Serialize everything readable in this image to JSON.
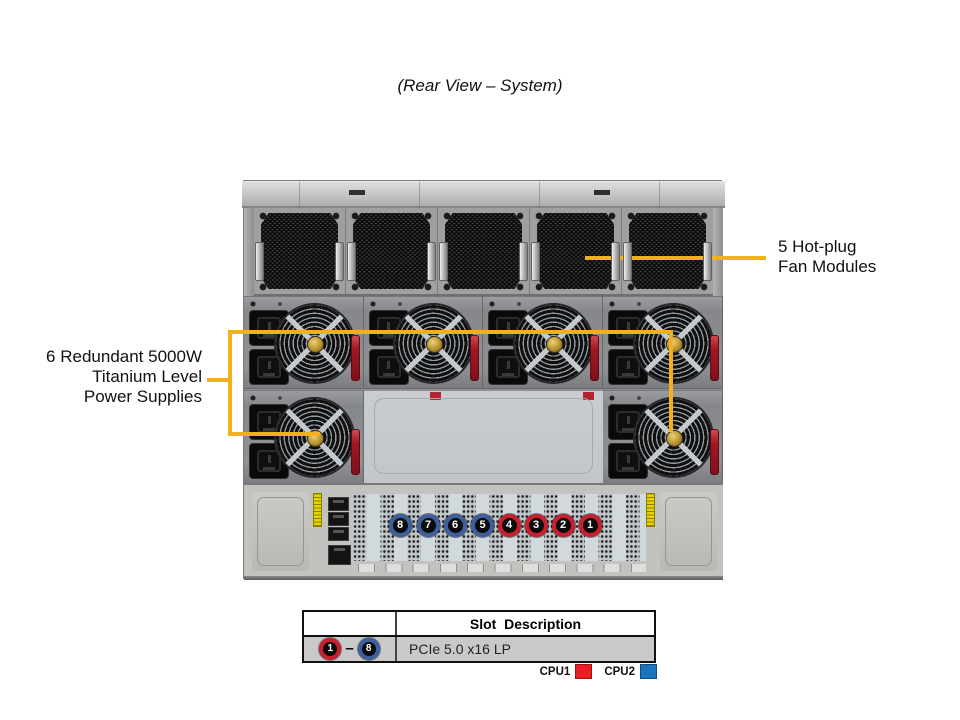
{
  "title": "(Rear View – System)",
  "callouts": {
    "fans": {
      "line1": "5 Hot-plug",
      "line2": "Fan Modules"
    },
    "psu": {
      "line1": "6 Redundant 5000W",
      "line2": "Titanium Level",
      "line3": "Power Supplies"
    }
  },
  "rear_slots": {
    "items": [
      {
        "number": "8",
        "cpu": "2"
      },
      {
        "number": "7",
        "cpu": "2"
      },
      {
        "number": "6",
        "cpu": "2"
      },
      {
        "number": "5",
        "cpu": "2"
      },
      {
        "number": "4",
        "cpu": "1"
      },
      {
        "number": "3",
        "cpu": "1"
      },
      {
        "number": "2",
        "cpu": "1"
      },
      {
        "number": "1",
        "cpu": "1"
      }
    ]
  },
  "table": {
    "header": "Slot  Description",
    "row": {
      "start_slot": "1",
      "start_cpu": "1",
      "dash": "–",
      "end_slot": "8",
      "end_cpu": "2",
      "description": "PCIe 5.0 x16 LP"
    }
  },
  "legend": {
    "cpu1_label": "CPU1",
    "cpu1_color": "#ec1c24",
    "cpu2_label": "CPU2",
    "cpu2_color": "#1b75bc"
  },
  "colors": {
    "callout_line": "#f2b01c",
    "slot_ring_cpu1": "#cb1f2d",
    "slot_ring_cpu2": "#3c5f9e"
  }
}
